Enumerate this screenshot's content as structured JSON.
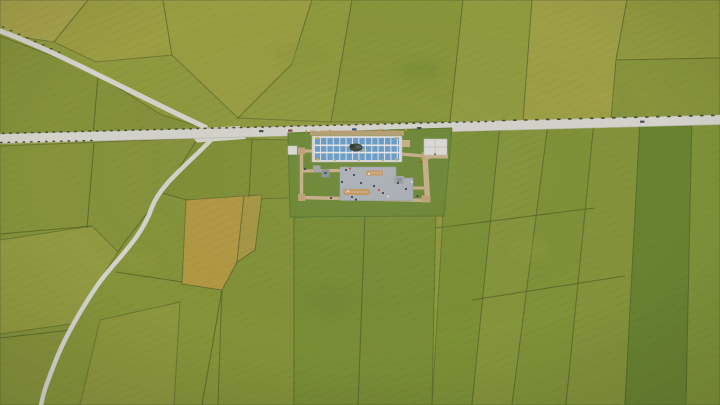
{
  "scene": {
    "type": "aerial-drone-photograph",
    "description": "Top-down aerial view of a patchwork of green, chartreuse and golden rice paddy fields divided by dark bunds, crossed by light rural roads; at the center a small tourist viewing-platform complex with a blue striped canopy roof, a dark sculpture under it, a gray plaza, tan boardwalk paths, white service buildings, parked vehicles and tiny pedestrians.",
    "objects": [
      "rice-paddy-fields",
      "field-boundaries",
      "main-road",
      "upper-left-country-road",
      "lower-left-country-road",
      "viewing-platform-complex",
      "blue-striped-canopy",
      "dark-sculpture",
      "gray-plaza",
      "orange-plaza-markings",
      "boardwalk",
      "pavilions",
      "white-buildings",
      "parked-vehicles",
      "pedestrians",
      "roadside-trees"
    ]
  },
  "palette": {
    "boundary": "#4f5e1f",
    "road": "#eae8e0",
    "road_edge": "#c9c6ba",
    "lawn": "#70902e",
    "lawn_edge": "#5d7b26",
    "boardwalk": "#d9bd90",
    "boardwalk_dark": "#cfae7c",
    "plaza": "#b9bfc6",
    "plaza_edge": "#a2a8b0",
    "canopy_blue": "#6aa6d8",
    "canopy_white": "#eef0ee",
    "canopy_frame": "#c6cbc9",
    "building_white": "#f2f1ec",
    "building_edge": "#d5d2c8",
    "statue": "#333d33",
    "statue_dark": "#222a22",
    "marking_orange": "#d6a058",
    "marking_light": "#f7ead2",
    "hedge": "#3f4d1e",
    "accent_yellow": "#e0bb5c",
    "person_dark": "#2e3a55",
    "person_white": "#f5f5f3",
    "person_red": "#c23b2e",
    "vehicle_white": "#e8e8e4",
    "vehicle_dark": "#434a52",
    "vehicle_red": "#8a4334",
    "vehicle_blue": "#2f4f82",
    "pavilion_gray": "#aab0b7",
    "pavilion_dark": "#9299a1",
    "field_a": "#b3ae48",
    "field_b": "#a7aa3e",
    "field_c": "#a5aa3d",
    "field_d": "#99a538",
    "field_e": "#90a034",
    "field_f": "#9aa73b",
    "field_g": "#aaac42",
    "field_h": "#9ba43a",
    "field_i": "#8f9e36",
    "field_j": "#8c9b35",
    "field_k": "#8e9d36",
    "field_l": "#9ca63c",
    "field_m": "#87992f",
    "field_gold": "#c1a43e",
    "field_gold2": "#b3a23f",
    "field_n": "#8d9e34",
    "field_o": "#95a139",
    "field_p": "#8a9c33",
    "field_q": "#7f962f",
    "field_r": "#82992f",
    "field_s": "#8d9f36",
    "field_t": "#879b32",
    "field_u": "#8b9d35",
    "field_v": "#6c8a2a",
    "field_w": "#849c33",
    "base_field": "#98a438"
  }
}
